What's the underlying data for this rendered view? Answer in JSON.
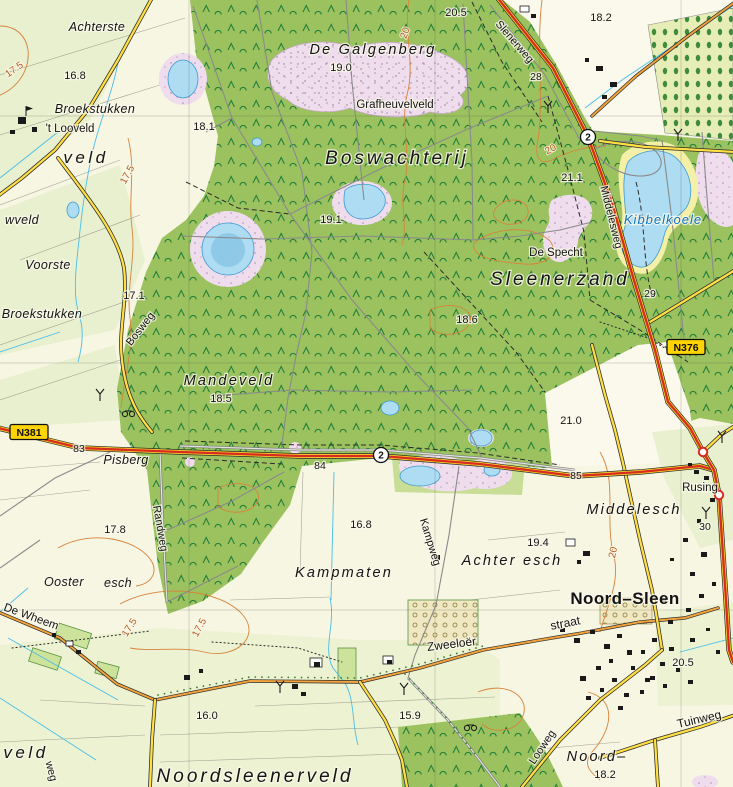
{
  "map": {
    "kind": "topographic-map",
    "palette": {
      "field_cream": "#F7F6E3",
      "field_green": "#E9F0CF",
      "forest_green": "#9CC25F",
      "tree_symbol": "#23803A",
      "heath_pink": "#EFDCEC",
      "water_blue": "#AEDCF2",
      "sand_yellow": "#F5F0A8",
      "road_major_red": "#D92C20",
      "road_secondary_yellow": "#FFDF43",
      "road_tertiary_orange": "#F2A33C",
      "contour_orange": "#D8823B",
      "shield_yellow": "#FFD400"
    },
    "route_badges": [
      {
        "kind": "shield",
        "label": "N381",
        "x": 29,
        "y": 432,
        "name": "route-shield-n381"
      },
      {
        "kind": "shield",
        "label": "N376",
        "x": 686,
        "y": 347,
        "name": "route-shield-n376"
      },
      {
        "kind": "circle",
        "label": "2",
        "x": 588,
        "y": 137,
        "name": "route-number-2-north"
      },
      {
        "kind": "circle",
        "label": "2",
        "x": 381,
        "y": 455,
        "name": "route-number-2-central"
      }
    ],
    "labels": [
      {
        "t": "Achterste",
        "x": 97,
        "y": 31,
        "c": "small-area",
        "n": "label-achterste"
      },
      {
        "t": "16.8",
        "x": 75,
        "y": 79,
        "c": "spot"
      },
      {
        "t": "Broekstukken",
        "x": 95,
        "y": 113,
        "c": "small-area",
        "n": "label-broekstukken-n"
      },
      {
        "t": "'t Looveld",
        "x": 70,
        "y": 132,
        "c": "place",
        "n": "label-t-looveld"
      },
      {
        "t": "veld",
        "x": 86,
        "y": 163,
        "c": "edge-area",
        "n": "label-veld-w"
      },
      {
        "t": "17.5",
        "x": 16,
        "y": 72,
        "c": "contour",
        "r": -35
      },
      {
        "t": "17.5",
        "x": 130,
        "y": 176,
        "c": "contour",
        "r": -62
      },
      {
        "t": "De Galgenberg",
        "x": 373,
        "y": 54,
        "c": "mid-area",
        "n": "label-de-galgenberg"
      },
      {
        "t": "19.0",
        "x": 341,
        "y": 71,
        "c": "spot"
      },
      {
        "t": "Grafheuvelveld",
        "x": 395,
        "y": 108,
        "c": "place",
        "n": "label-grafheuvelveld"
      },
      {
        "t": "20.5",
        "x": 456,
        "y": 16,
        "c": "spot"
      },
      {
        "t": "Boswachterij",
        "x": 397,
        "y": 164,
        "c": "area-xl",
        "n": "label-boswachterij"
      },
      {
        "t": "Slenerweg",
        "x": 512,
        "y": 44,
        "c": "road",
        "r": 49,
        "n": "label-slenerweg"
      },
      {
        "t": "28",
        "x": 536,
        "y": 80,
        "c": "km"
      },
      {
        "t": "18.2",
        "x": 601,
        "y": 21,
        "c": "spot"
      },
      {
        "t": "21.1",
        "x": 572,
        "y": 181,
        "c": "spot"
      },
      {
        "t": "Middelesweg",
        "x": 608,
        "y": 218,
        "c": "road",
        "r": 76,
        "n": "label-middelesweg"
      },
      {
        "t": "Kibbelkoele",
        "x": 663,
        "y": 224,
        "c": "water",
        "n": "label-kibbelkoele"
      },
      {
        "t": "De Specht",
        "x": 556,
        "y": 256,
        "c": "place",
        "n": "label-de-specht"
      },
      {
        "t": "Sleenerzand",
        "x": 560,
        "y": 285,
        "c": "area-xl",
        "n": "label-sleenerzand"
      },
      {
        "t": "29",
        "x": 650,
        "y": 297,
        "c": "km"
      },
      {
        "t": "17.1",
        "x": 134,
        "y": 299,
        "c": "spot"
      },
      {
        "t": "Bosweg",
        "x": 143,
        "y": 331,
        "c": "road",
        "r": -52,
        "n": "label-bosweg"
      },
      {
        "t": "Voorste",
        "x": 48,
        "y": 269,
        "c": "small-area",
        "n": "label-voorste"
      },
      {
        "t": "Broekstukken",
        "x": 42,
        "y": 318,
        "c": "small-area",
        "n": "label-broekstukken-s"
      },
      {
        "t": "wveld",
        "x": 22,
        "y": 224,
        "c": "small-area",
        "n": "label-wveld"
      },
      {
        "t": "19.1",
        "x": 331,
        "y": 223,
        "c": "spot"
      },
      {
        "t": "18.1",
        "x": 204,
        "y": 130,
        "c": "spot"
      },
      {
        "t": "18.6",
        "x": 467,
        "y": 323,
        "c": "spot"
      },
      {
        "t": "Mandeveld",
        "x": 229,
        "y": 385,
        "c": "mid-area",
        "n": "label-mandeveld"
      },
      {
        "t": "18.5",
        "x": 221,
        "y": 402,
        "c": "spot"
      },
      {
        "t": "83",
        "x": 79,
        "y": 452,
        "c": "km"
      },
      {
        "t": "84",
        "x": 320,
        "y": 469,
        "c": "km"
      },
      {
        "t": "85",
        "x": 576,
        "y": 479,
        "c": "km"
      },
      {
        "t": "Pisberg",
        "x": 126,
        "y": 464,
        "c": "small-area",
        "n": "label-pisberg"
      },
      {
        "t": "Randweg",
        "x": 157,
        "y": 529,
        "c": "road",
        "r": 80,
        "n": "label-randweg"
      },
      {
        "t": "17.8",
        "x": 115,
        "y": 533,
        "c": "spot"
      },
      {
        "t": "16.8",
        "x": 361,
        "y": 528,
        "c": "spot"
      },
      {
        "t": "Kampweg",
        "x": 427,
        "y": 543,
        "c": "road",
        "r": 73,
        "n": "label-kampweg"
      },
      {
        "t": "Kampmaten",
        "x": 344,
        "y": 577,
        "c": "mid-area",
        "n": "label-kampmaten"
      },
      {
        "t": "Achter esch",
        "x": 512,
        "y": 565,
        "c": "mid-area",
        "n": "label-achter-esch"
      },
      {
        "t": "Middelesch",
        "x": 634,
        "y": 514,
        "c": "mid-area",
        "n": "label-middelesch"
      },
      {
        "t": "19.4",
        "x": 538,
        "y": 546,
        "c": "spot"
      },
      {
        "t": "21.0",
        "x": 571,
        "y": 424,
        "c": "spot"
      },
      {
        "t": "Rusing",
        "x": 700,
        "y": 491,
        "c": "place",
        "n": "label-rusing"
      },
      {
        "t": "30",
        "x": 705,
        "y": 530,
        "c": "km"
      },
      {
        "t": "Noord–Sleen",
        "x": 625,
        "y": 604,
        "c": "bold-place",
        "n": "label-noord-sleen"
      },
      {
        "t": "Ooster",
        "x": 64,
        "y": 586,
        "c": "small-area",
        "n": "label-ooster"
      },
      {
        "t": "esch",
        "x": 118,
        "y": 587,
        "c": "small-area",
        "n": "label-esch"
      },
      {
        "t": "De Wheem",
        "x": 30,
        "y": 620,
        "c": "place",
        "r": 20,
        "n": "label-de-wheem"
      },
      {
        "t": "17.5",
        "x": 132,
        "y": 629,
        "c": "contour",
        "r": -58
      },
      {
        "t": "17.5",
        "x": 202,
        "y": 629,
        "c": "contour",
        "r": -62
      },
      {
        "t": "16.0",
        "x": 207,
        "y": 719,
        "c": "spot"
      },
      {
        "t": "veld",
        "x": 26,
        "y": 758,
        "c": "edge-area",
        "n": "label-veld-sw"
      },
      {
        "t": "weg",
        "x": 48,
        "y": 772,
        "c": "road",
        "r": 76,
        "n": "label-weg"
      },
      {
        "t": "Noordsleenerveld",
        "x": 255,
        "y": 782,
        "c": "area-xl",
        "n": "label-noordsleenerveld"
      },
      {
        "t": "Zweeloër",
        "x": 452,
        "y": 648,
        "c": "street",
        "r": -7,
        "n": "label-zweeloer"
      },
      {
        "t": "straat",
        "x": 566,
        "y": 627,
        "c": "street",
        "r": -11,
        "n": "label-straat"
      },
      {
        "t": "15.9",
        "x": 410,
        "y": 719,
        "c": "spot"
      },
      {
        "t": "20.5",
        "x": 683,
        "y": 666,
        "c": "spot"
      },
      {
        "t": "Tuinweg",
        "x": 700,
        "y": 723,
        "c": "street",
        "r": -13,
        "n": "label-tuinweg"
      },
      {
        "t": "Looweg",
        "x": 545,
        "y": 749,
        "c": "road",
        "r": -56,
        "n": "label-looweg"
      },
      {
        "t": "Noord–",
        "x": 597,
        "y": 761,
        "c": "mid-area",
        "n": "label-noord"
      },
      {
        "t": "18.2",
        "x": 605,
        "y": 778,
        "c": "spot"
      },
      {
        "t": "20",
        "x": 408,
        "y": 34,
        "c": "contour",
        "r": -70
      },
      {
        "t": "20",
        "x": 552,
        "y": 152,
        "c": "contour",
        "r": -28
      },
      {
        "t": "20",
        "x": 616,
        "y": 553,
        "c": "contour",
        "r": -78
      }
    ]
  }
}
